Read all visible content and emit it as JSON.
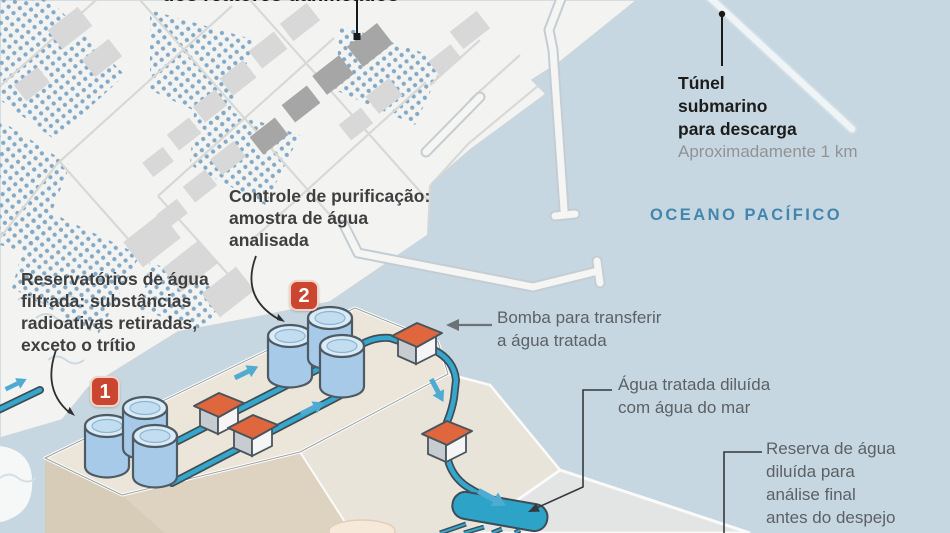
{
  "figure": {
    "type": "isometric-process-infographic-over-map",
    "labels": {
      "damaged_reactors_partial": "dos reatores danificados",
      "purification_control": "Controle de purificação:\namostra de água\nanalisada",
      "filtered_water_tanks": "Reservatórios de água\nfiltrada: substâncias\nradioativas retiradas,\nexceto o trítio",
      "transfer_pump": "Bomba para transferir\na água tratada",
      "diluted_water": "Água tratada diluída\ncom água do mar",
      "dilution_reserve": "Reserva de água\ndiluída para\nanálise final\nantes do despejo",
      "undersea_tunnel_title": "Túnel\nsubmarino\npara descarga",
      "undersea_tunnel_length": "Aproximadamente 1 km",
      "ocean_name": "OCEANO PACÍFICO"
    },
    "badges": [
      {
        "number": "1"
      },
      {
        "number": "2"
      }
    ],
    "colors": {
      "ocean": "#c7d7e1",
      "land": "#f3f4f2",
      "badge_red": "#ca4630",
      "pipe_teal": "#35a7cc",
      "flow_arrow_blue": "#4fabd1",
      "pump_roof_orange": "#e0673d",
      "tank_blue": "#a6cae7",
      "platform_beige": "#ebe6d9",
      "ocean_text_blue": "#4286ae",
      "reactor_building_gray": "#a5a6a5"
    }
  }
}
